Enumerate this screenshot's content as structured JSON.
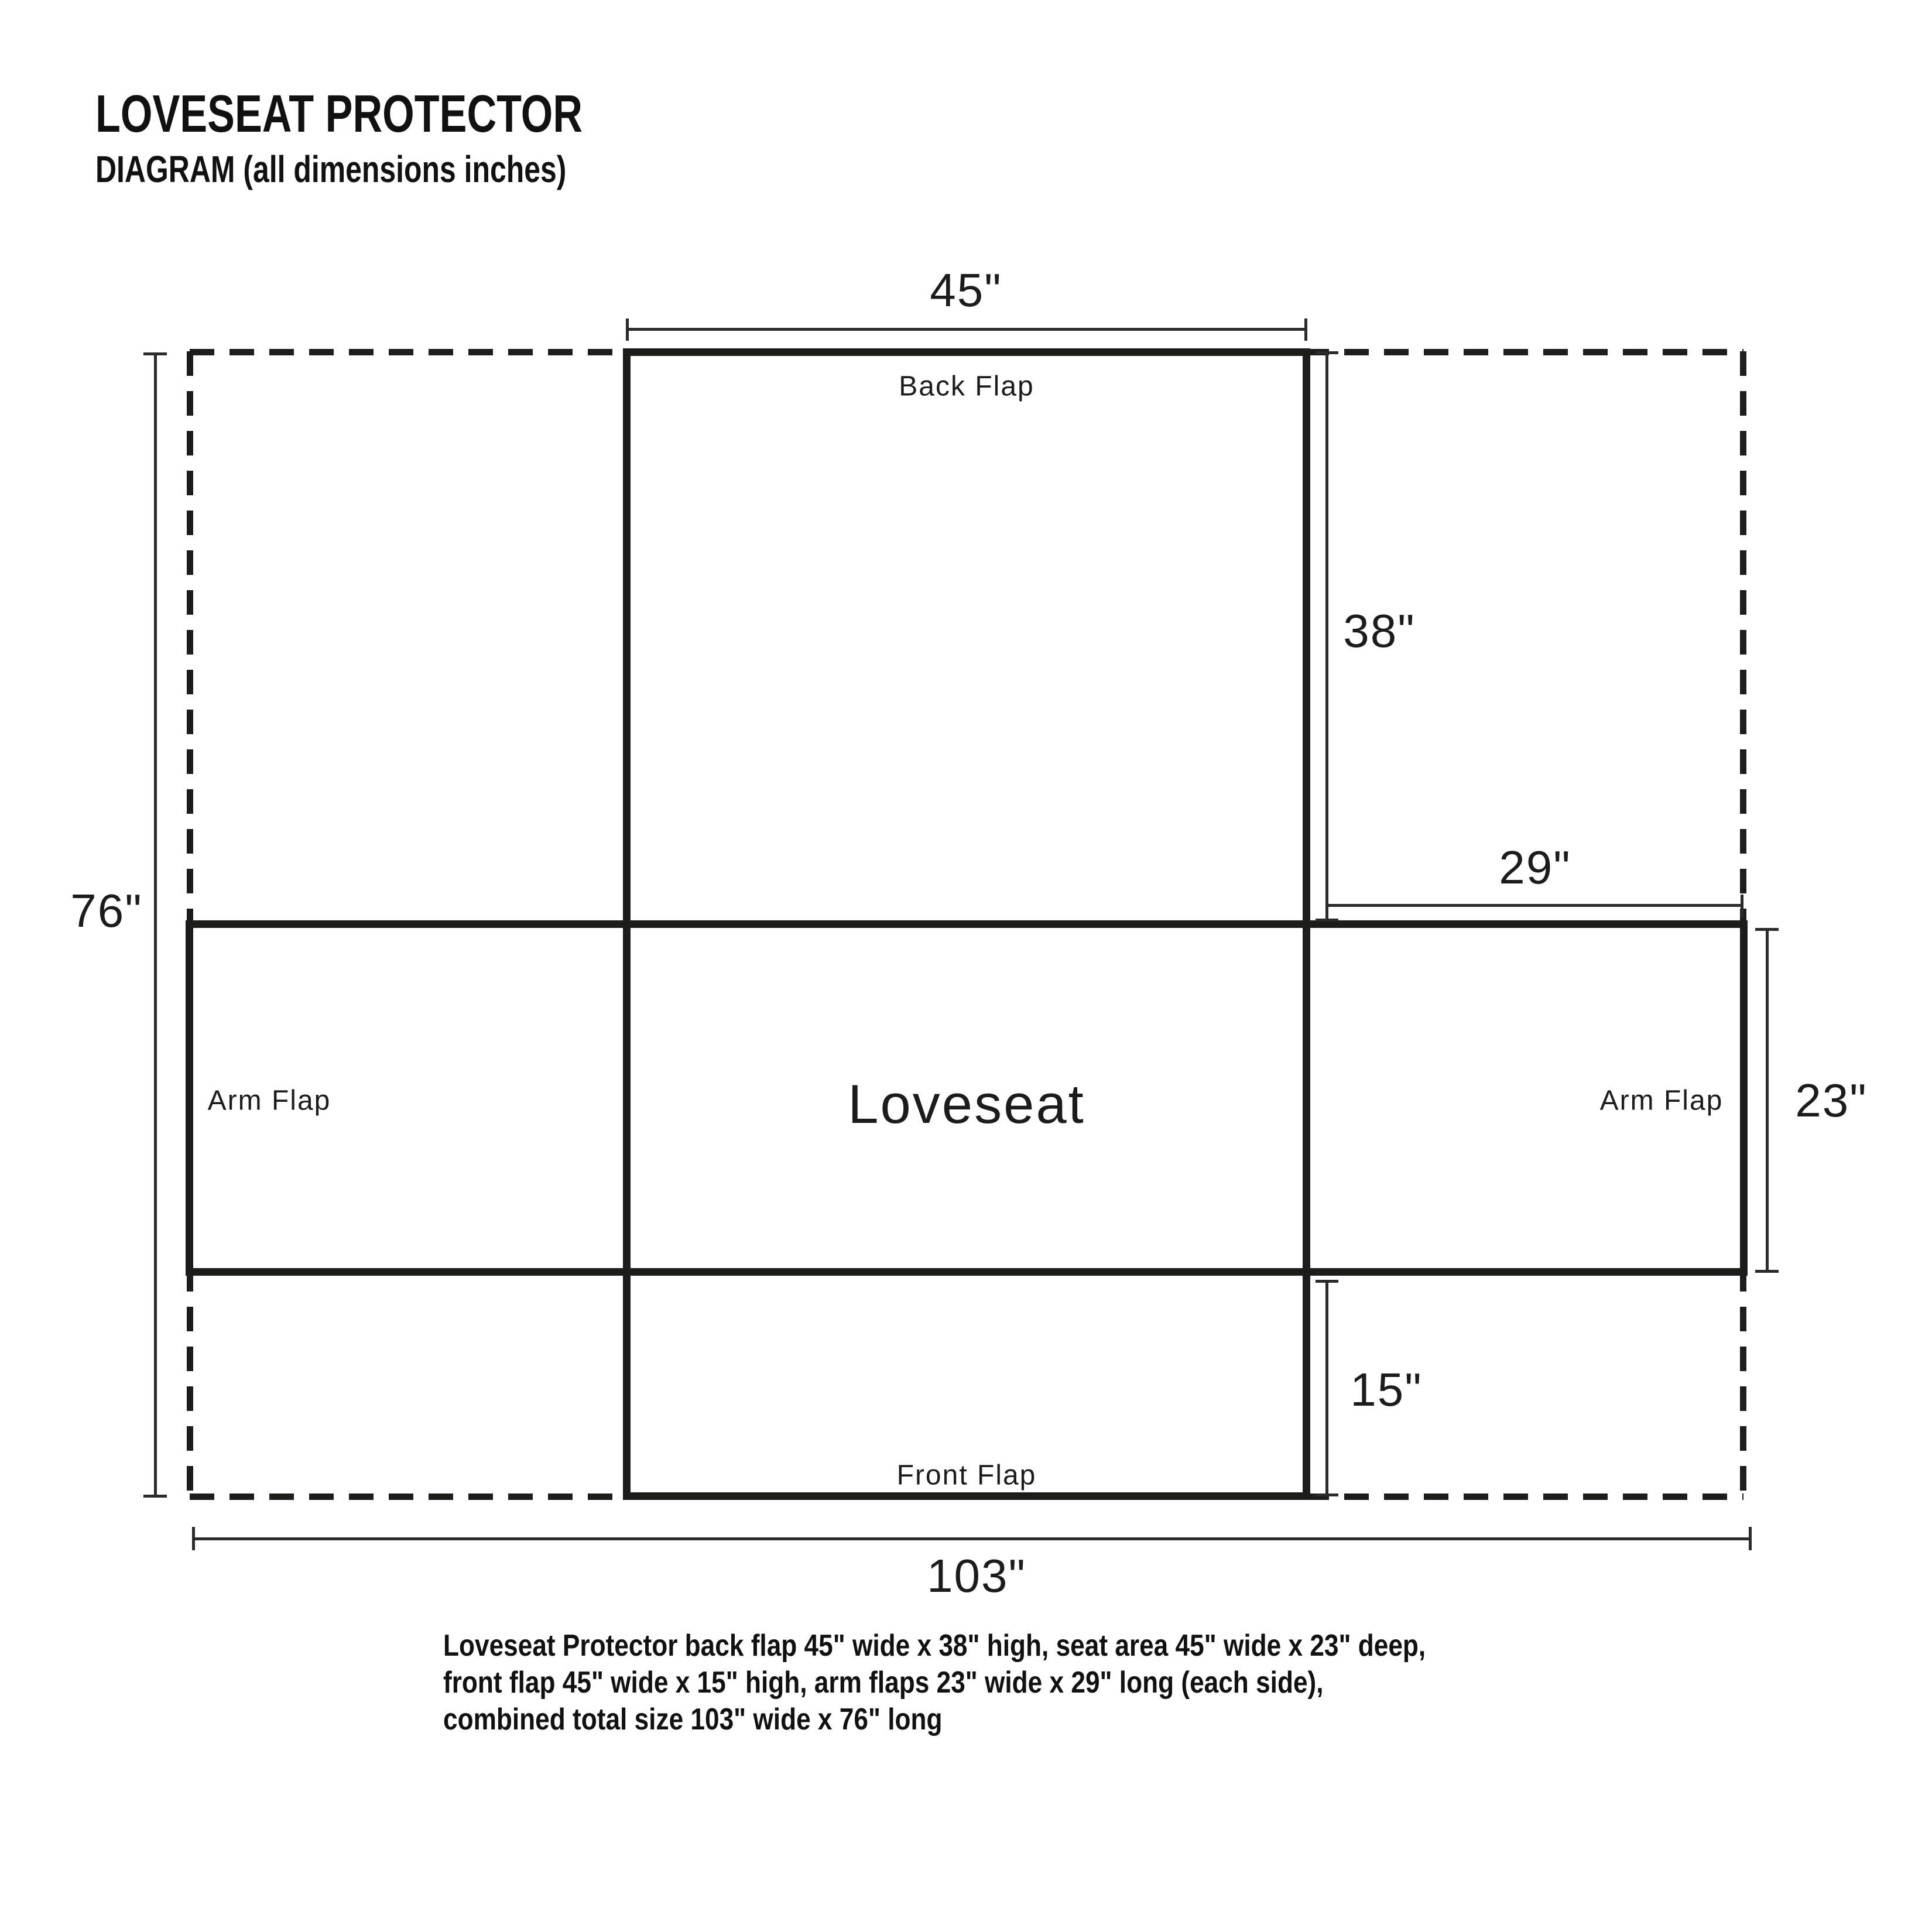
{
  "header": {
    "title": "LOVESEAT PROTECTOR",
    "subtitle": "DIAGRAM (all dimensions inches)"
  },
  "diagram": {
    "panels": {
      "back_flap": "Back Flap",
      "seat": "Loveseat",
      "front_flap": "Front Flap",
      "arm_flap_left": "Arm Flap",
      "arm_flap_right": "Arm Flap"
    },
    "dimensions": {
      "back_flap_width": "45\"",
      "back_flap_height": "38\"",
      "arm_flap_length": "29\"",
      "arm_flap_width": "23\"",
      "front_flap_height": "15\"",
      "total_length": "76\"",
      "total_width": "103\""
    }
  },
  "caption": {
    "line1": "Loveseat Protector back flap 45\" wide x 38\" high, seat area 45\" wide x 23\" deep,",
    "line2": "front flap 45\" wide x 15\" high, arm flaps 23\" wide x 29\" long (each side),",
    "line3": "combined total size 103\" wide x 76\" long"
  },
  "colors": {
    "line_color": "#1d1d1b",
    "dimension_line_color": "#2b2b2b",
    "text_color": "#1c1c1c",
    "background": "#ffffff"
  }
}
